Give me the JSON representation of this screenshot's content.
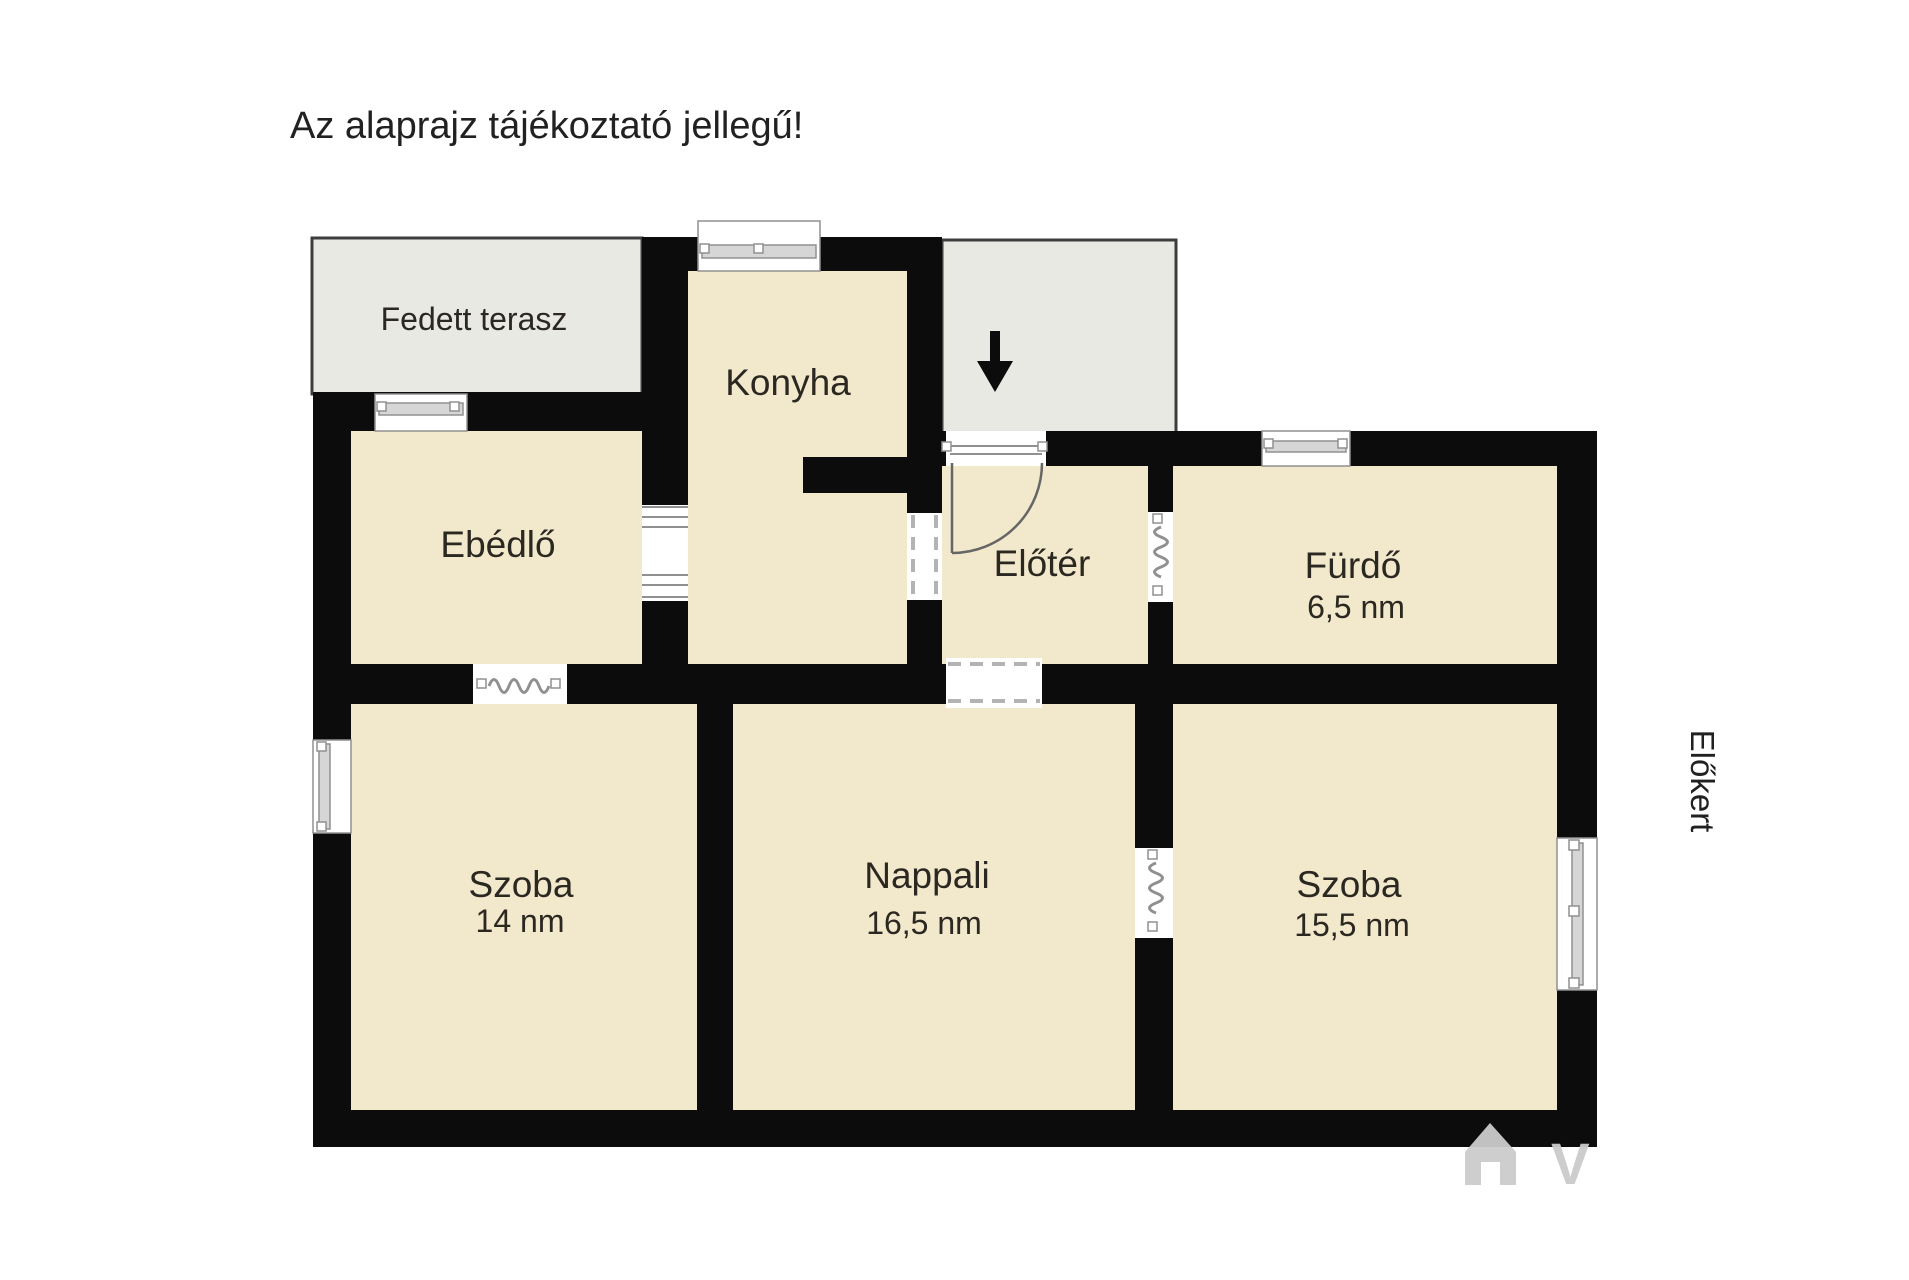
{
  "title": "Az alaprajz tájékoztató jellegű!",
  "outdoor_label": "Előkert",
  "watermark": {
    "letter": "V",
    "icon": "house-logo"
  },
  "entrance": {
    "icon": "down-arrow"
  },
  "rooms": {
    "terrace": {
      "name": "Fedett terasz",
      "area": ""
    },
    "kitchen": {
      "name": "Konyha",
      "area": ""
    },
    "dining": {
      "name": "Ebédlő",
      "area": ""
    },
    "hall": {
      "name": "Előtér",
      "area": ""
    },
    "bathroom": {
      "name": "Fürdő",
      "area": "6,5 nm"
    },
    "room_left": {
      "name": "Szoba",
      "area": "14 nm"
    },
    "living": {
      "name": "Nappali",
      "area": "16,5 nm"
    },
    "room_right": {
      "name": "Szoba",
      "area": "15,5 nm"
    }
  },
  "colors": {
    "background": "#ffffff",
    "wall": "#0c0c0c",
    "floor": "#f2e8cb",
    "terrace": "#e9e9e3",
    "terrace_border": "#3d3d3d",
    "window_frame": "#909090",
    "window_glass": "#d6d6d6",
    "door_line": "#666666",
    "dash_line": "#b3b3b3",
    "text": "#2b2721",
    "title_text": "#212121",
    "watermark": "#cbcbcb"
  }
}
